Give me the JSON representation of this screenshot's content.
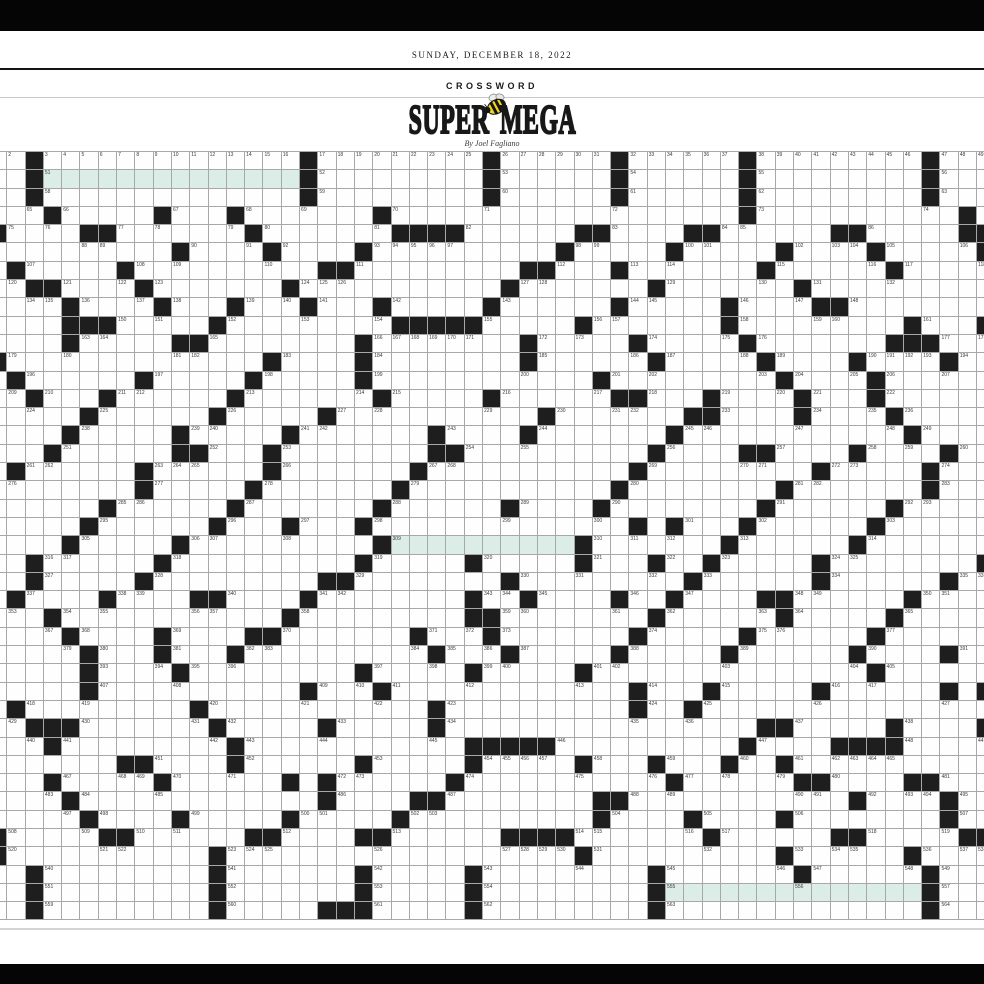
{
  "page": {
    "background": "#ffffff",
    "frame_bar_color": "#050505"
  },
  "masthead": {
    "date": "SUNDAY, DECEMBER 18, 2022",
    "section": "CROSSWORD",
    "title_word1": "SUPER",
    "title_word2": "MEGA",
    "byline": "By Joel Fagliano",
    "bee_icon": "bee-icon",
    "bee_colors": {
      "body": "#f2d519",
      "stripes": "#141414",
      "wings": "#ededed"
    }
  },
  "grid": {
    "rows": 42,
    "cols": 55,
    "cell_pitch_px": 18.3,
    "colors": {
      "line": "#a8a8a8",
      "black_cell": "#1e1e1e",
      "white_cell": "#fefefe",
      "highlight_cell": "#dcede8",
      "number": "#3a3a3a"
    },
    "legend": {
      ".": "white",
      "#": "black",
      "H": "highlighted"
    },
    "highlight_bands": [
      {
        "row": 1,
        "col_start": 3,
        "col_end": 16
      },
      {
        "row": 21,
        "col_start": 22,
        "col_end": 31
      },
      {
        "row": 40,
        "col_start": 37,
        "col_end": 50
      }
    ],
    "rows_data": [
      "..#..............#.........#......#......#.........#...",
      "..#HHHHHHHHHHHHHH#.........#......#......#.........#...",
      "..#..............#.........#......#......#.........#...",
      "...#.....#...#.......#...................#...........#.",
      "#....##.......#.......####......##....##......##.....##",
      "..........#....#....#..........#.....#.....#....#.....#",
      ".#.....#..........##.........##...#.......#......#.....",
      "..##....#.......#...........#.......#.......#..........",
      "....#....#...#...#...#.....#......#.....#....##........",
      "....###.....#.........#####.....#.......#.........#...#",
      "....#.....##........#........#.....#.....#.......###...",
      "#..............#....#........#......#.....#....#....#..",
      ".#......#.....#.....#............#.........#....#......",
      "..#...#......#.......#.....#......##...#....#...#......",
      ".....#......#.....#...........#.......##....#....#.....",
      "....#.....#.....#.......#....#.......#............#....",
      "...#......##...#........##..........#....##....#....#..",
      ".#......#......#.......#...........#.........#.....#...",
      "........#.....#.......#...........#........#.......#...",
      "......#......#.......#......#....#........#......#.....",
      ".....#......#...#...#..............#.#...#......#......",
      "....#.....#..........#HHHHHHHHHH#.......#......#.......",
      "..#......#..........#.....#.....#...#..#.....#........#",
      "..#.....#.........##........#.........#......#......#..",
      ".#....#....##....#........#..#....#..#....##......#....",
      "...#............#.........##........#......#.....#.....",
      "....#....#....##.......#...#.......#.....#......#......",
      ".....#...#...#..........#...#.....#.....#......#....#..",
      ".....#....#.........#.....#.....#...............#......",
      ".....#...........#...#.............#...#.....#......#.#",
      ".#.........#............#..........#..#................",
      "..###.......#.....#.....#.................##.....#....#",
      "...#.........#............#####..........#....####.....",
      ".......##....#......#.....#.....#...#...#..#...........",
      "...#.....#......#.#......#...........#......##....##...",
      "....#.............#....##........##............#....#..",
      ".....#....#.....#.....#..........#....#....#........#..",
      "#.....##......##....##......####.......#......##.....##",
      "#...........#...................#..........#......#....",
      "..#.........#.......#.....#.........#.......#......#...",
      "..#.........#.......#.....#.........#HHHHHHHHHHHHHH#...",
      "..#.........#.....###.....#.........#..............#..."
    ]
  }
}
